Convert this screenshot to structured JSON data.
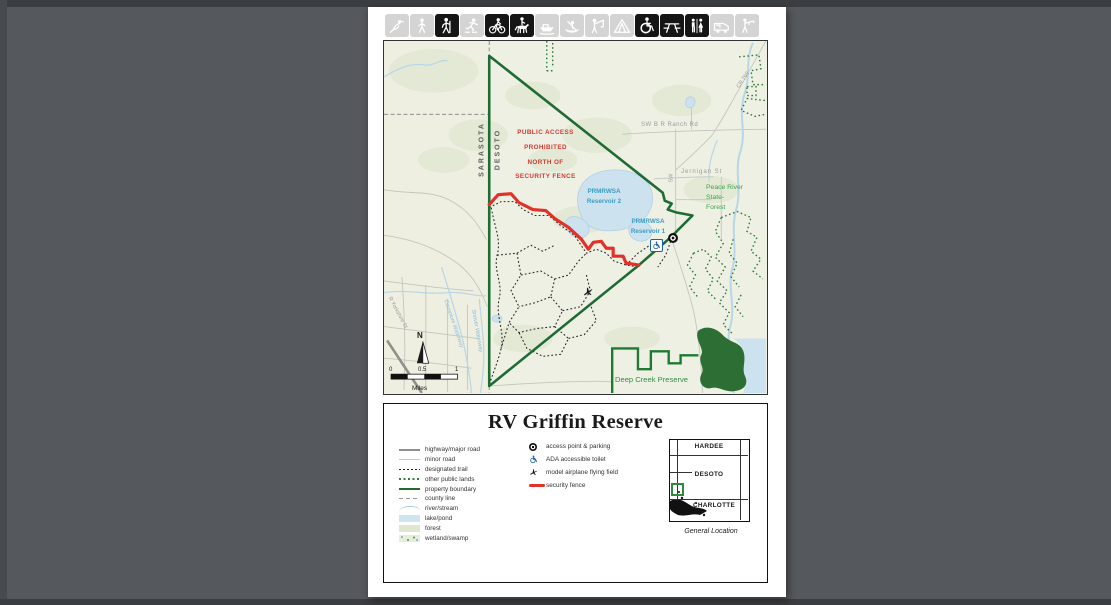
{
  "toolbar": {
    "icons": [
      {
        "name": "bird-watching",
        "active": false
      },
      {
        "name": "walking",
        "active": false
      },
      {
        "name": "hiking",
        "active": true
      },
      {
        "name": "skating",
        "active": false
      },
      {
        "name": "biking",
        "active": true
      },
      {
        "name": "horseback-riding",
        "active": true
      },
      {
        "name": "boating",
        "active": false
      },
      {
        "name": "canoeing",
        "active": false
      },
      {
        "name": "fishing",
        "active": false
      },
      {
        "name": "camping",
        "active": false
      },
      {
        "name": "ada-accessible",
        "active": true
      },
      {
        "name": "picnicking",
        "active": true
      },
      {
        "name": "restrooms",
        "active": true
      },
      {
        "name": "rv-camping",
        "active": false
      },
      {
        "name": "hunting",
        "active": false
      }
    ]
  },
  "map": {
    "warning": [
      "PUBLIC ACCESS",
      "PROHIBITED",
      "NORTH OF",
      "SECURITY FENCE"
    ],
    "counties": {
      "left": "SARASOTA",
      "right": "DESOTO"
    },
    "labels": {
      "reservoir2": [
        "PRMRWSA",
        "Reservoir 2"
      ],
      "reservoir1": [
        "PRMRWSA",
        "Reservoir 1"
      ],
      "ranch_rd": "SW  B R Ranch Rd",
      "jernigan": "Jernigan  St",
      "sw_road": "SW",
      "cr769": "CR 769",
      "peace_river": [
        "Peace River",
        "State-",
        "Forest"
      ],
      "deep_creek": "Deep Creek Preserve",
      "cocoplum": "Cocoplum Waterway",
      "snover": "Snover Waterway",
      "yorkshire": "R Yorkshire St",
      "north": "N"
    },
    "scale": {
      "ticks": [
        "0",
        "0.5",
        "1"
      ],
      "unit": "Miles"
    }
  },
  "panel": {
    "title": "RV Griffin Reserve",
    "legend_lines": [
      {
        "key": "highway",
        "label": "highway/major road"
      },
      {
        "key": "minor",
        "label": "minor road"
      },
      {
        "key": "trail",
        "label": "designated trail"
      },
      {
        "key": "publiclands",
        "label": "other public lands"
      },
      {
        "key": "boundary",
        "label": "property boundary"
      },
      {
        "key": "county",
        "label": "county line"
      },
      {
        "key": "river",
        "label": "river/stream"
      },
      {
        "key": "lake",
        "label": "lake/pond"
      },
      {
        "key": "forest",
        "label": "forest"
      },
      {
        "key": "wetland",
        "label": "wetland/swamp"
      }
    ],
    "legend_points": [
      {
        "key": "access",
        "label": "access point & parking"
      },
      {
        "key": "ada",
        "label": "ADA accessible toilet"
      },
      {
        "key": "airplane",
        "label": "model airplane flying field"
      },
      {
        "key": "fence",
        "label": "security fence"
      }
    ],
    "inset": {
      "counties": [
        "HARDEE",
        "DESOTO",
        "CHARLOTTE"
      ],
      "caption": "General Location"
    }
  },
  "colors": {
    "background": "#55585c",
    "property_boundary_green": "#1e6b34",
    "security_fence_red": "#e23128",
    "water_blue": "#cde2ef",
    "label_blue": "#3d9cc6",
    "warning_red": "#d23a30",
    "public_lands_green": "#2e7d3a",
    "forest_green_text": "#3da34e"
  }
}
